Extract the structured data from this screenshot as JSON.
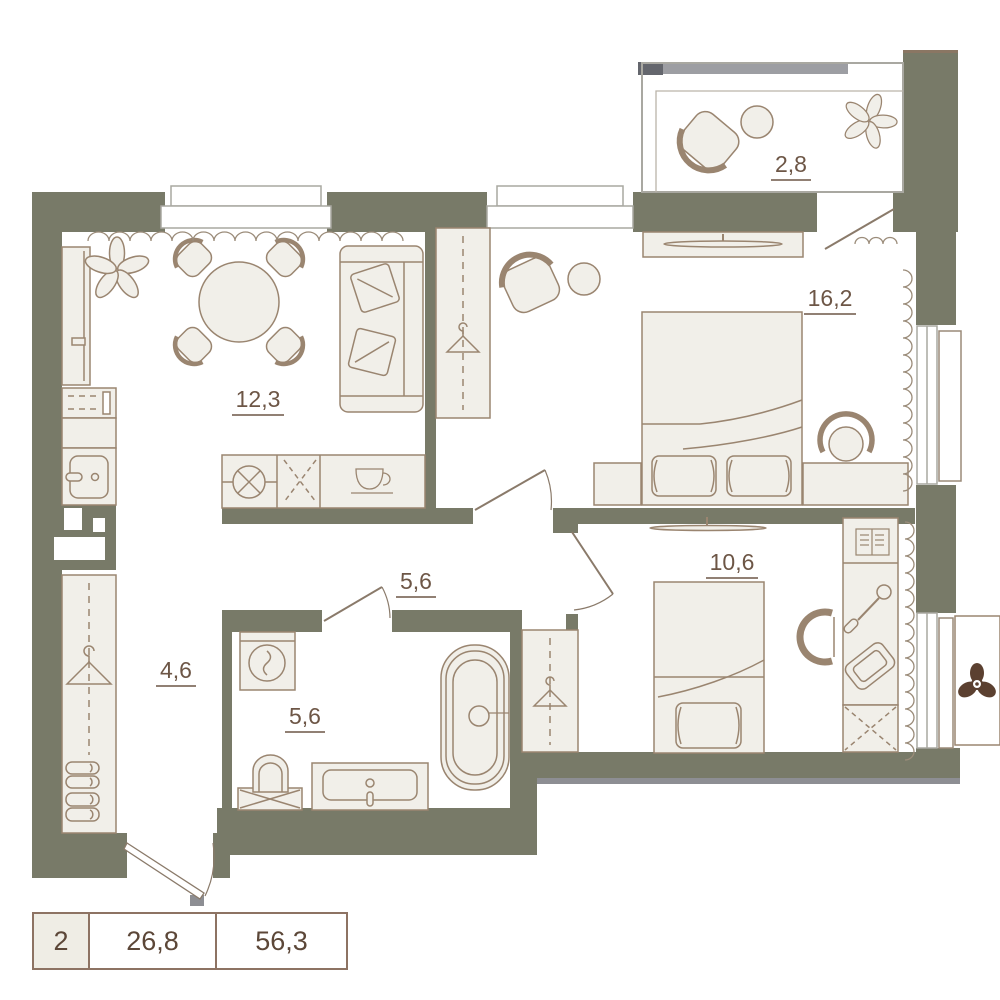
{
  "plan": {
    "title": "2-room apartment floor plan",
    "rooms": [
      {
        "id": "living-kitchen",
        "area": "12,3"
      },
      {
        "id": "bedroom-1",
        "area": "16,2"
      },
      {
        "id": "bedroom-2",
        "area": "10,6"
      },
      {
        "id": "hallway",
        "area": "5,6"
      },
      {
        "id": "bathroom",
        "area": "5,6"
      },
      {
        "id": "corridor",
        "area": "4,6"
      },
      {
        "id": "balcony",
        "area": "2,8"
      }
    ]
  },
  "legend": {
    "rooms_count": "2",
    "living_area": "26,8",
    "total_area": "56,3"
  },
  "icons": [
    "hanger-icon",
    "plant-icon",
    "bed-icon",
    "sofa-icon",
    "bathtub-icon",
    "toilet-icon",
    "sink-icon",
    "washing-machine-icon",
    "cup-icon",
    "stove-icon",
    "book-icon",
    "pencil-icon",
    "tablet-icon",
    "fan-icon",
    "tv-icon"
  ],
  "colors": {
    "wall": "#787a68",
    "furniture_fill": "#f1efe9",
    "furniture_stroke": "#9a8570",
    "label": "#6d5646",
    "shadow": "#8d8e93",
    "window_frame": "#a9a8a1",
    "legend_border": "#8d7363"
  }
}
